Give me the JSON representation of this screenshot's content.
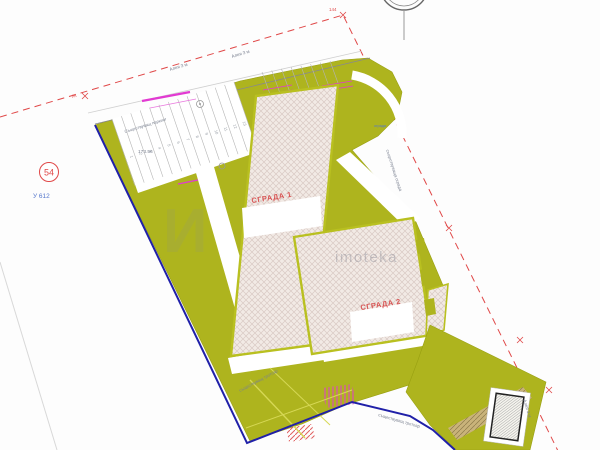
{
  "plan": {
    "labels": {
      "building1": "СГРАДА 1",
      "building2": "СГРАДА 2",
      "parcel_number": "54",
      "point_label": "У 612",
      "corner_label": "144",
      "watermark_text": "imoteka",
      "watermark_mark": "И",
      "alley_top1": "Алея 3 м",
      "alley_top2": "Алея 3 м",
      "alley_right": "Алея 3 м",
      "existing_parking": "Съществуващ паркинг",
      "elevation": "173.56",
      "fence_label": "съществуваща ограда",
      "fence_small": "ограда",
      "sidewalk_label1": "съществуващ тротоар",
      "sidewalk_label2": "съществуващ тротоар",
      "boundary_mark": "ЛК"
    },
    "parking_numbers": [
      "1",
      "2",
      "3",
      "4",
      "5",
      "6",
      "7",
      "8",
      "9",
      "10",
      "11",
      "12",
      "13"
    ],
    "colors": {
      "site_olive": "#aeb41e",
      "building_border": "#b9c020",
      "building_fill": "#f2eae5",
      "hatch_line": "#d9c9c4",
      "cadastral_red": "#e04848",
      "boundary_blue": "#2020a8",
      "accent_magenta": "#e23ad2",
      "label_red": "#d85555",
      "text_gray": "#7a8090",
      "text_blue": "#5577cc",
      "tan_strip": "#c9b37a",
      "watermark_gray": "#8a8f98"
    }
  }
}
